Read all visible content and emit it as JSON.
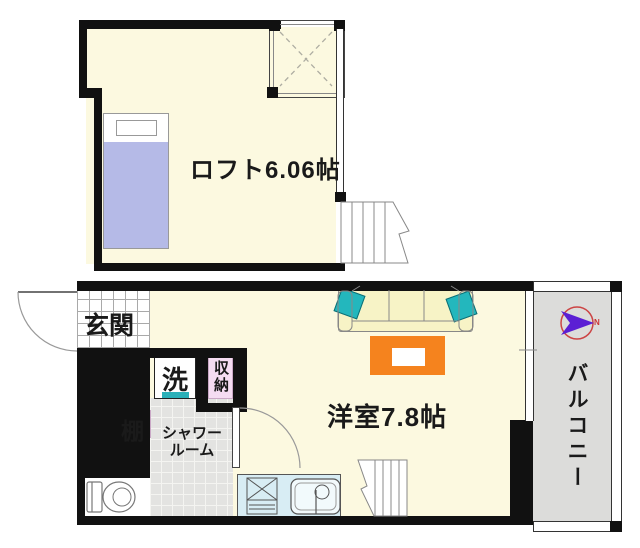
{
  "rooms": {
    "loft": {
      "label": "ロフト6.06帖"
    },
    "main_room": {
      "label": "洋室7.8帖"
    },
    "entrance": {
      "label": "玄関"
    },
    "balcony": {
      "label": "バルコニー"
    },
    "shower_room": {
      "label_line1": "シャワー",
      "label_line2": "ルーム"
    },
    "washer": {
      "label": "洗"
    },
    "storage": {
      "label": "収納"
    },
    "shelf": {
      "label": "棚"
    }
  },
  "compass": {
    "north_label": "N"
  },
  "colors": {
    "floor_cream": "#fcf9e0",
    "wall_black": "#111111",
    "bed_blanket_purple": "#b5bae7",
    "utility_pink": "#f5dcf2",
    "washer_accent_teal": "#2ab0b8",
    "shower_floor_gray": "#e3e3e1",
    "kitchen_counter_blue": "#d8edf4",
    "sofa_cream": "#f7f3c6",
    "cushion_teal": "#23b7bd",
    "table_orange": "#f5831e",
    "balcony_gray": "#dcdcda",
    "compass_circle_red": "#cc4444",
    "compass_arrow_purple": "#5b1fd4"
  }
}
